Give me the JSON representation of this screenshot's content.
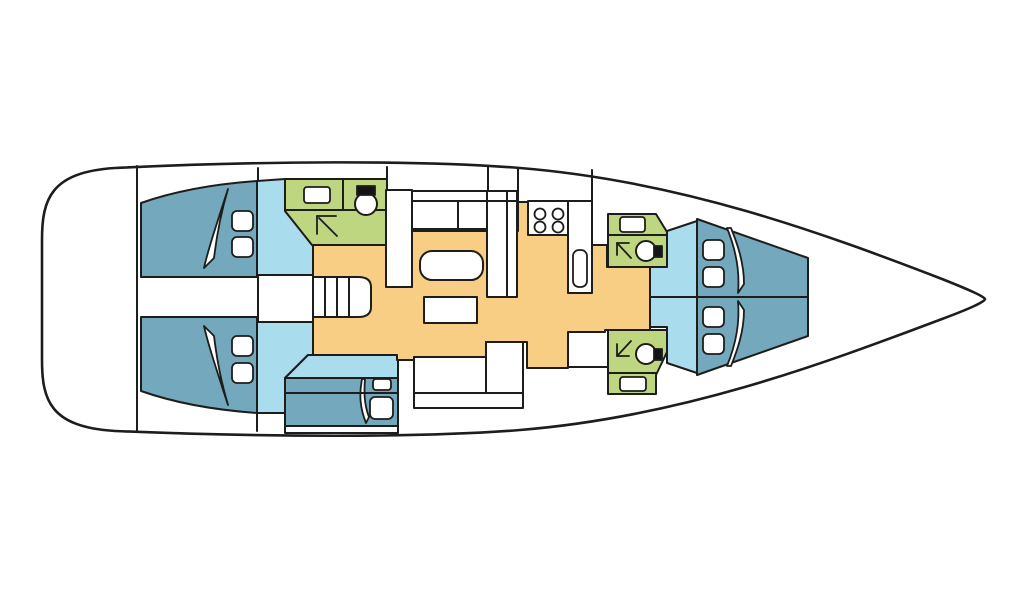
{
  "diagram": {
    "kind": "sailing-yacht-interior-floor-plan-top-view",
    "colors": {
      "background": "#ffffff",
      "outline": "#1d1d1b",
      "hull_fill": "#ffffff",
      "berth_blue": "#74a8bc",
      "floor_light_blue": "#a9dcec",
      "bathroom_green": "#bdd67f",
      "saloon_orange": "#f8cd84",
      "fixture_white": "#ffffff",
      "toilet_lid_black": "#141414"
    },
    "rooms": [
      {
        "name": "stern-deck"
      },
      {
        "name": "aft-cabin-starboard"
      },
      {
        "name": "aft-cabin-port"
      },
      {
        "name": "aft-bathroom"
      },
      {
        "name": "companionway"
      },
      {
        "name": "saloon"
      },
      {
        "name": "galley"
      },
      {
        "name": "midship-cabin"
      },
      {
        "name": "bow-bathroom-starboard"
      },
      {
        "name": "bow-bathroom-port"
      },
      {
        "name": "bow-cabin-starboard"
      },
      {
        "name": "bow-cabin-port"
      },
      {
        "name": "bow-deck"
      }
    ],
    "fixtures": [
      "double-berth",
      "v-berth",
      "pillow",
      "duvet-fold",
      "washbasin",
      "toilet",
      "shower-arrow",
      "stove-4-burner",
      "galley-sink",
      "galley-counter",
      "settee",
      "saloon-table",
      "coffee-table",
      "stairs"
    ]
  }
}
